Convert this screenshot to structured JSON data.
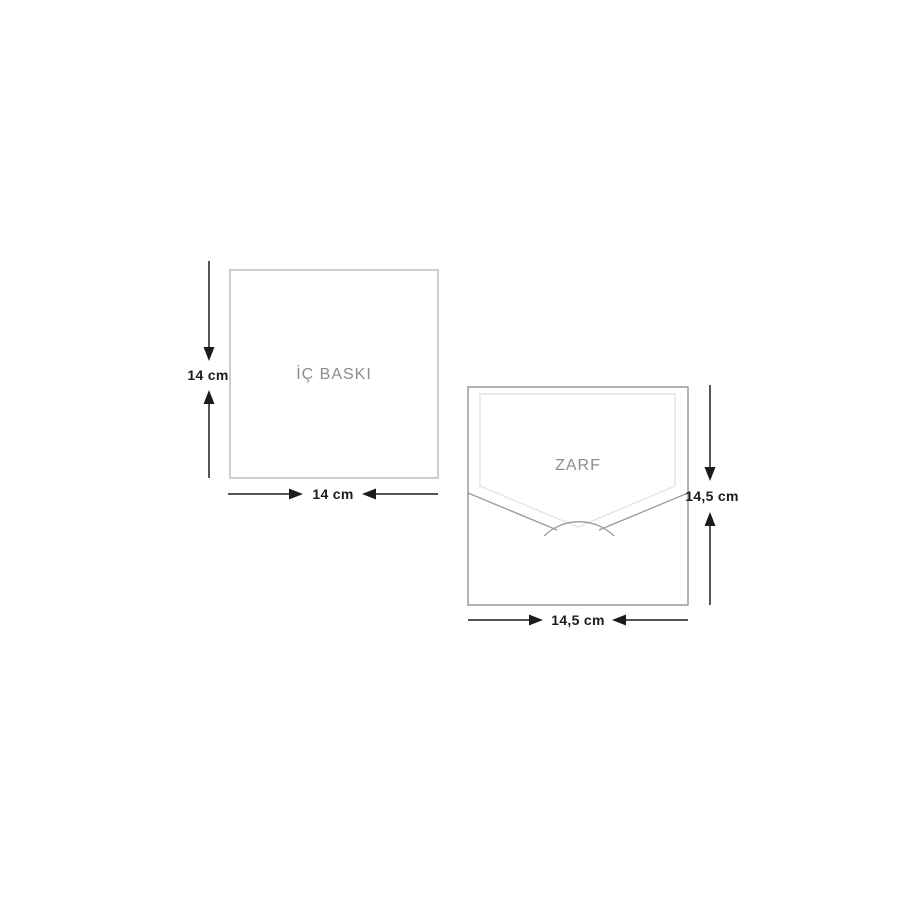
{
  "diagram": {
    "background": "#ffffff",
    "inner_print": {
      "label": "İÇ BASKI",
      "width_label": "14 cm",
      "height_label": "14 cm"
    },
    "envelope": {
      "label": "ZARF",
      "width_label": "14,5 cm",
      "height_label": "14,5 cm"
    },
    "colors": {
      "background": "#ffffff",
      "inner_print_border": "#bdbdbd",
      "envelope_border": "#9a9a9a",
      "flap_outline": "#e4e4e4",
      "pocket_line": "#9a9a9a",
      "shape_label_text": "#8d8d8d",
      "dimension_text": "#1c1c1c",
      "dimension_line": "#1c1c1c"
    }
  }
}
